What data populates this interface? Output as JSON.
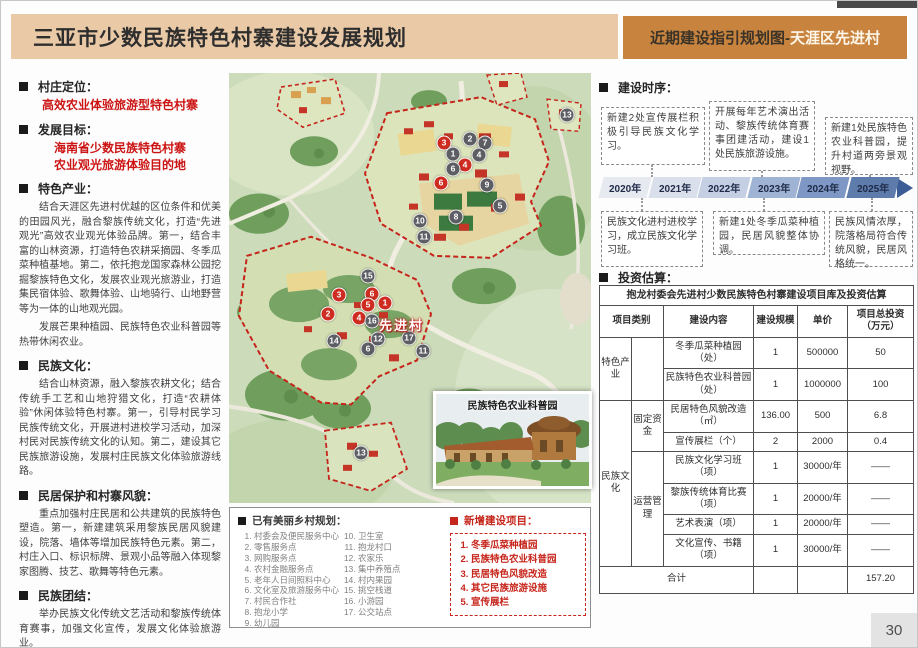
{
  "header": {
    "title": "三亚市少数民族特色村寨建设发展规划",
    "right_prefix": "近期建设指引规划图-",
    "right_highlight": "天涯区先进村"
  },
  "left_sections": {
    "s1_heading": "村庄定位：",
    "s1_red1": "高效农业体验旅游型特色村寨",
    "s2_heading": "发展目标：",
    "s2_red1": "海南省少数民族特色村寨",
    "s2_red2": "农业观光旅游体验目的地",
    "s3_heading": "特色产业：",
    "s3_p1": "结合天涯区先进村优越的区位条件和优美的田园风光，融合黎族传统文化，打造“先进观光”高效农业观光体验品牌。第一，结合丰富的山林资源，打造特色农耕采摘园、冬季瓜菜种植基地。第二，依托抱龙国家森林公园挖掘黎族特色文化，发展农业观光旅游业，打造集民宿体验、歌舞体验、山地骑行、山地野营等为一体的山地观光园。",
    "s3_p2": "发展芒果种植园、民族特色农业科普园等热带休闲农业。",
    "s4_heading": "民族文化：",
    "s4_p1": "结合山林资源，融入黎族农耕文化；结合传统手工艺和山地狩猎文化，打造“农耕体验”休闲体验特色村寨。第一，引导村民学习民族传统文化，开展进村进校学习活动，加深村民对民族传统文化的认知。第二，建设其它民族旅游设施，发展村庄民族文化体验旅游线路。",
    "s5_heading": "民居保护和村寨风貌：",
    "s5_p1": "重点加强村庄民居和公共建筑的民族特色塑造。第一，新建建筑采用黎族民居风貌建设，院落、墙体等增加民族特色元素。第二，村庄入口、标识标牌、景观小品等融入体现黎家图腾、技艺、歌舞等特色元素。",
    "s6_heading": "民族团结：",
    "s6_p1": "举办民族文化传统文艺活动和黎族传统体育赛事，加强文化宣传，发展文化体验旅游业。"
  },
  "map": {
    "village_label": "先进村",
    "inset_title": "民族特色农业科普园",
    "markers": [
      {
        "n": "3",
        "t": "red",
        "x": 215,
        "y": 70
      },
      {
        "n": "2",
        "t": "gray",
        "x": 241,
        "y": 66
      },
      {
        "n": "7",
        "t": "gray",
        "x": 256,
        "y": 70
      },
      {
        "n": "1",
        "t": "gray",
        "x": 224,
        "y": 81
      },
      {
        "n": "4",
        "t": "gray",
        "x": 250,
        "y": 82
      },
      {
        "n": "4",
        "t": "red",
        "x": 236,
        "y": 92
      },
      {
        "n": "6",
        "t": "gray",
        "x": 224,
        "y": 96
      },
      {
        "n": "9",
        "t": "gray",
        "x": 258,
        "y": 112
      },
      {
        "n": "6",
        "t": "red",
        "x": 212,
        "y": 110
      },
      {
        "n": "5",
        "t": "gray",
        "x": 271,
        "y": 133
      },
      {
        "n": "8",
        "t": "gray",
        "x": 227,
        "y": 144
      },
      {
        "n": "10",
        "t": "gray",
        "x": 191,
        "y": 148
      },
      {
        "n": "11",
        "t": "gray",
        "x": 195,
        "y": 164
      },
      {
        "n": "13",
        "t": "gray",
        "x": 338,
        "y": 42
      },
      {
        "n": "15",
        "t": "gray",
        "x": 139,
        "y": 203
      },
      {
        "n": "3",
        "t": "red",
        "x": 110,
        "y": 222
      },
      {
        "n": "6",
        "t": "red",
        "x": 143,
        "y": 221
      },
      {
        "n": "5",
        "t": "red",
        "x": 139,
        "y": 232
      },
      {
        "n": "1",
        "t": "red",
        "x": 156,
        "y": 230
      },
      {
        "n": "2",
        "t": "red",
        "x": 99,
        "y": 241
      },
      {
        "n": "4",
        "t": "red",
        "x": 130,
        "y": 245
      },
      {
        "n": "16",
        "t": "gray",
        "x": 143,
        "y": 248
      },
      {
        "n": "14",
        "t": "gray",
        "x": 105,
        "y": 268
      },
      {
        "n": "12",
        "t": "gray",
        "x": 149,
        "y": 266
      },
      {
        "n": "6",
        "t": "gray",
        "x": 139,
        "y": 276
      },
      {
        "n": "17",
        "t": "gray",
        "x": 180,
        "y": 265
      },
      {
        "n": "11",
        "t": "gray",
        "x": 194,
        "y": 278
      },
      {
        "n": "13",
        "t": "gray",
        "x": 132,
        "y": 380
      }
    ]
  },
  "legend": {
    "existing_heading": "已有美丽乡村规划：",
    "existing_col1": [
      "村委会及便民服务中心",
      "零售服务点",
      "网购服务点",
      "农村金融服务点",
      "老年人日间照料中心",
      "文化室及旅游服务中心",
      "村民合作社",
      "抱龙小学",
      "幼儿园"
    ],
    "existing_col2": [
      "卫生室",
      "抱龙村口",
      "农家乐",
      "集中养殖点",
      "村内果园",
      "挑空栈道",
      "小游园",
      "公交站点"
    ],
    "new_heading": "新增建设项目：",
    "new_items": [
      "冬季瓜菜种植园",
      "民族特色农业科普园",
      "民居特色风貌改造",
      "其它民族旅游设施",
      "宣传展栏"
    ]
  },
  "sequence": {
    "heading": "建设时序：",
    "top_boxes": [
      "新建2处宣传展栏积极引导民族文化学习。",
      "开展每年艺术演出活动、黎族传统体育赛事团建活动，建设1处民族旅游设施。",
      "新建1处民族特色农业科普园，提升村道两旁景观视野。"
    ],
    "bottom_boxes": [
      "民族文化进村进校学习，成立民族文化学习班。",
      "新建1处冬季瓜菜种植园，民居风貌整体协调。",
      "民族风情浓厚，院落格局符合传统风貌，民居风格统一。"
    ],
    "years": [
      {
        "label": "2020年",
        "color": "#e6e9f0"
      },
      {
        "label": "2021年",
        "color": "#d9dfeb"
      },
      {
        "label": "2022年",
        "color": "#c5cfe3"
      },
      {
        "label": "2023年",
        "color": "#9fb3d4"
      },
      {
        "label": "2024年",
        "color": "#7e97c4"
      },
      {
        "label": "2025年",
        "color": "#5e7cab"
      }
    ]
  },
  "invest": {
    "heading": "投资估算：",
    "table_title": "抱龙村委会先进村少数民族特色村寨建设项目库及投资估算",
    "headers": {
      "category": "项目类别",
      "content": "建设内容",
      "scale": "建设规模",
      "price": "单价",
      "total": "项目总投资（万元）"
    },
    "cat1": "特色产业",
    "cat2": "民族文化",
    "sub_fixed": "固定资金",
    "sub_oper": "运营管理",
    "rows": [
      {
        "content": "冬季瓜菜种植园（处）",
        "scale": "1",
        "price": "500000",
        "total": "50"
      },
      {
        "content": "民族特色农业科普园（处）",
        "scale": "1",
        "price": "1000000",
        "total": "100"
      },
      {
        "content": "民居特色风貌改造（㎡）",
        "scale": "136.00",
        "price": "500",
        "total": "6.8"
      },
      {
        "content": "宣传展栏（个）",
        "scale": "2",
        "price": "2000",
        "total": "0.4"
      },
      {
        "content": "民族文化学习班（项）",
        "scale": "1",
        "price": "30000/年",
        "total": "——"
      },
      {
        "content": "黎族传统体育比赛（项）",
        "scale": "1",
        "price": "20000/年",
        "total": "——"
      },
      {
        "content": "艺术表演（项）",
        "scale": "1",
        "price": "20000/年",
        "total": "——"
      },
      {
        "content": "文化宣传、书籍（项）",
        "scale": "1",
        "price": "30000/年",
        "total": "——"
      }
    ],
    "footer_label": "合计",
    "footer_total": "157.20"
  },
  "page_number": "30",
  "colors": {
    "header_left_bg": "#eac9a6",
    "header_right_bg": "#c8843e",
    "accent_red": "#c6251b",
    "timeline_arrow": "#3c5c96"
  }
}
